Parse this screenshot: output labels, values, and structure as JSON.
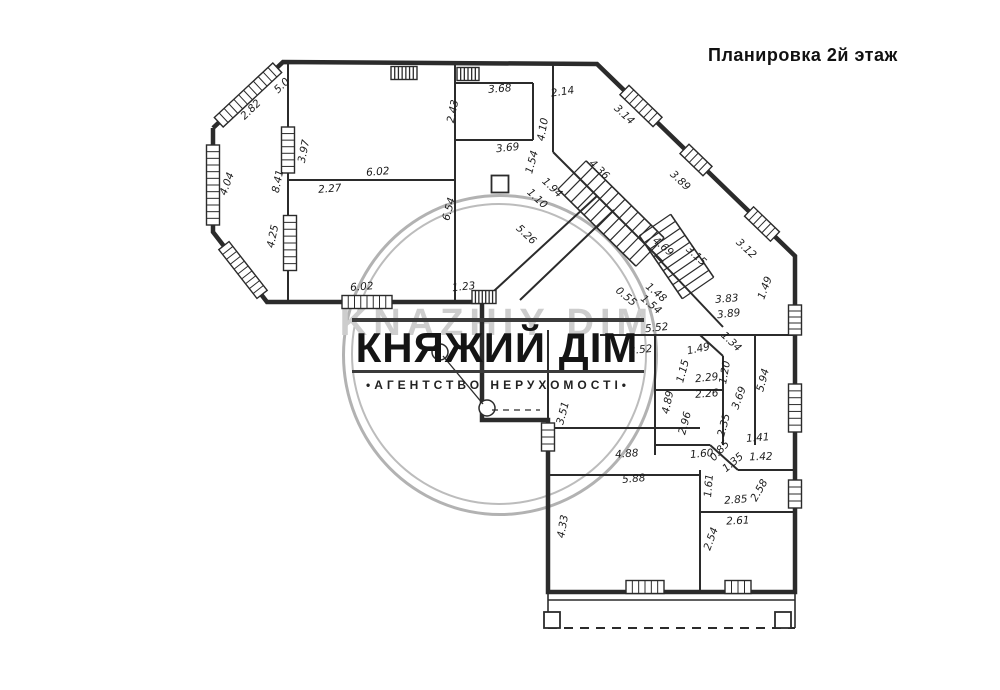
{
  "title": "Планировка 2й этаж",
  "watermark": {
    "name": "КНЯЖИЙ ДІМ",
    "name_latin": "KNAZHIY DIM",
    "tagline": "•АГЕНТСТВО НЕРУХОМОСТІ•",
    "circle_color": "#b2b2b2",
    "text_color": "#141414"
  },
  "plan": {
    "stroke": "#2b2b2b",
    "outer": [
      [
        213,
        128
      ],
      [
        283,
        62
      ],
      [
        597,
        64
      ],
      [
        795,
        256
      ],
      [
        795,
        592
      ],
      [
        548,
        592
      ],
      [
        548,
        420
      ],
      [
        482,
        420
      ],
      [
        482,
        302
      ],
      [
        267,
        302
      ],
      [
        213,
        232
      ],
      [
        213,
        128
      ]
    ],
    "walls": [
      [
        [
          288,
          64
        ],
        [
          288,
          302
        ]
      ],
      [
        [
          288,
          180
        ],
        [
          455,
          180
        ]
      ],
      [
        [
          455,
          64
        ],
        [
          455,
          302
        ]
      ],
      [
        [
          455,
          140
        ],
        [
          533,
          140
        ]
      ],
      [
        [
          533,
          83
        ],
        [
          533,
          140
        ]
      ],
      [
        [
          455,
          83
        ],
        [
          533,
          83
        ]
      ],
      [
        [
          553,
          64
        ],
        [
          553,
          152
        ]
      ],
      [
        [
          553,
          152
        ],
        [
          663,
          262
        ]
      ],
      [
        [
          597,
          196
        ],
        [
          482,
          302
        ]
      ],
      [
        [
          614,
          210
        ],
        [
          520,
          300
        ]
      ],
      [
        [
          655,
          255
        ],
        [
          723,
          327
        ]
      ],
      [
        [
          548,
          330
        ],
        [
          548,
          592
        ]
      ],
      [
        [
          600,
          335
        ],
        [
          795,
          335
        ]
      ],
      [
        [
          700,
          335
        ],
        [
          723,
          356
        ]
      ],
      [
        [
          655,
          335
        ],
        [
          655,
          455
        ]
      ],
      [
        [
          655,
          390
        ],
        [
          723,
          390
        ]
      ],
      [
        [
          723,
          356
        ],
        [
          723,
          445
        ]
      ],
      [
        [
          655,
          445
        ],
        [
          710,
          445
        ]
      ],
      [
        [
          710,
          445
        ],
        [
          738,
          470
        ]
      ],
      [
        [
          738,
          470
        ],
        [
          795,
          470
        ]
      ],
      [
        [
          755,
          335
        ],
        [
          755,
          445
        ]
      ],
      [
        [
          548,
          428
        ],
        [
          700,
          428
        ]
      ],
      [
        [
          548,
          475
        ],
        [
          700,
          475
        ]
      ],
      [
        [
          700,
          470
        ],
        [
          700,
          592
        ]
      ],
      [
        [
          700,
          512
        ],
        [
          795,
          512
        ]
      ]
    ],
    "windows": [
      {
        "cx": 248,
        "cy": 95,
        "len": 80,
        "rot": -43,
        "dense": false
      },
      {
        "cx": 213,
        "cy": 185,
        "len": 80,
        "rot": 90,
        "dense": false
      },
      {
        "cx": 243,
        "cy": 270,
        "len": 62,
        "rot": 52,
        "dense": false
      },
      {
        "cx": 288,
        "cy": 150,
        "len": 46,
        "rot": 90,
        "dense": false
      },
      {
        "cx": 290,
        "cy": 243,
        "len": 55,
        "rot": 90,
        "dense": false
      },
      {
        "cx": 404,
        "cy": 73,
        "len": 26,
        "rot": 0,
        "dense": true
      },
      {
        "cx": 468,
        "cy": 74,
        "len": 22,
        "rot": 0,
        "dense": true
      },
      {
        "cx": 641,
        "cy": 106,
        "len": 46,
        "rot": 44,
        "dense": false
      },
      {
        "cx": 696,
        "cy": 160,
        "len": 32,
        "rot": 44,
        "dense": false
      },
      {
        "cx": 762,
        "cy": 224,
        "len": 36,
        "rot": 44,
        "dense": false
      },
      {
        "cx": 795,
        "cy": 320,
        "len": 30,
        "rot": 90,
        "dense": false
      },
      {
        "cx": 795,
        "cy": 408,
        "len": 48,
        "rot": 90,
        "dense": false
      },
      {
        "cx": 795,
        "cy": 494,
        "len": 28,
        "rot": 90,
        "dense": false
      },
      {
        "cx": 548,
        "cy": 437,
        "len": 28,
        "rot": 90,
        "dense": false
      },
      {
        "cx": 645,
        "cy": 587,
        "len": 38,
        "rot": 0,
        "dense": false
      },
      {
        "cx": 738,
        "cy": 587,
        "len": 26,
        "rot": 0,
        "dense": false
      },
      {
        "cx": 367,
        "cy": 302,
        "len": 50,
        "rot": 0,
        "dense": false
      },
      {
        "cx": 484,
        "cy": 297,
        "len": 24,
        "rot": 0,
        "dense": true
      }
    ],
    "stairs": [
      {
        "x1": 572,
        "y1": 175,
        "x2": 650,
        "y2": 252,
        "w": 40,
        "n": 12
      },
      {
        "x1": 655,
        "y1": 225,
        "x2": 698,
        "y2": 288,
        "w": 38,
        "n": 9
      }
    ],
    "labels": [
      {
        "t": "2.82",
        "x": 253,
        "y": 112,
        "r": -44
      },
      {
        "t": "5.0",
        "x": 284,
        "y": 88,
        "r": -44
      },
      {
        "t": "3.97",
        "x": 307,
        "y": 152,
        "r": -78
      },
      {
        "t": "2.43",
        "x": 456,
        "y": 112,
        "r": -78
      },
      {
        "t": "6.02",
        "x": 378,
        "y": 175,
        "r": -4
      },
      {
        "t": "2.27",
        "x": 330,
        "y": 192,
        "r": -4
      },
      {
        "t": "8.41",
        "x": 281,
        "y": 182,
        "r": -78
      },
      {
        "t": "4.04",
        "x": 230,
        "y": 185,
        "r": -70
      },
      {
        "t": "4.25",
        "x": 276,
        "y": 237,
        "r": -78
      },
      {
        "t": "6.02",
        "x": 362,
        "y": 290,
        "r": -4
      },
      {
        "t": "3.68",
        "x": 500,
        "y": 92,
        "r": -4
      },
      {
        "t": "2.14",
        "x": 563,
        "y": 95,
        "r": -8
      },
      {
        "t": "3.69",
        "x": 508,
        "y": 151,
        "r": -6
      },
      {
        "t": "1.54",
        "x": 535,
        "y": 163,
        "r": -75
      },
      {
        "t": "4.10",
        "x": 546,
        "y": 130,
        "r": -80
      },
      {
        "t": "3.14",
        "x": 622,
        "y": 117,
        "r": 43
      },
      {
        "t": "4.36",
        "x": 597,
        "y": 172,
        "r": 43
      },
      {
        "t": "1.94",
        "x": 550,
        "y": 190,
        "r": 43
      },
      {
        "t": "1.10",
        "x": 535,
        "y": 201,
        "r": 43
      },
      {
        "t": "5.26",
        "x": 524,
        "y": 237,
        "r": 43
      },
      {
        "t": "1.23",
        "x": 464,
        "y": 290,
        "r": -6
      },
      {
        "t": "6.54",
        "x": 452,
        "y": 210,
        "r": -75
      },
      {
        "t": "3.89",
        "x": 678,
        "y": 183,
        "r": 43
      },
      {
        "t": "4.69",
        "x": 661,
        "y": 249,
        "r": 40
      },
      {
        "t": "3.15",
        "x": 694,
        "y": 258,
        "r": 43
      },
      {
        "t": "3.12",
        "x": 744,
        "y": 251,
        "r": 43
      },
      {
        "t": "0.55",
        "x": 624,
        "y": 299,
        "r": 40
      },
      {
        "t": "1.48",
        "x": 654,
        "y": 295,
        "r": 40
      },
      {
        "t": "1.54",
        "x": 649,
        "y": 307,
        "r": 40
      },
      {
        "t": "5.52",
        "x": 657,
        "y": 331,
        "r": -6
      },
      {
        "t": "3.83",
        "x": 727,
        "y": 302,
        "r": -4
      },
      {
        "t": "3.89",
        "x": 729,
        "y": 317,
        "r": -6
      },
      {
        "t": "1.49",
        "x": 768,
        "y": 289,
        "r": -70
      },
      {
        "t": "3.52",
        "x": 641,
        "y": 353,
        "r": -6
      },
      {
        "t": "1.49",
        "x": 699,
        "y": 352,
        "r": -12
      },
      {
        "t": "1.34",
        "x": 729,
        "y": 344,
        "r": 43
      },
      {
        "t": "1.15",
        "x": 686,
        "y": 372,
        "r": -75
      },
      {
        "t": "2.29",
        "x": 707,
        "y": 381,
        "r": -6
      },
      {
        "t": "1.20",
        "x": 728,
        "y": 373,
        "r": -80
      },
      {
        "t": "2.26",
        "x": 707,
        "y": 397,
        "r": -4
      },
      {
        "t": "4.89",
        "x": 671,
        "y": 403,
        "r": -78
      },
      {
        "t": "3.69",
        "x": 742,
        "y": 399,
        "r": -70
      },
      {
        "t": "5.94",
        "x": 766,
        "y": 381,
        "r": -75
      },
      {
        "t": "2.96",
        "x": 688,
        "y": 424,
        "r": -75
      },
      {
        "t": "2.35",
        "x": 727,
        "y": 426,
        "r": -75
      },
      {
        "t": "1.60",
        "x": 702,
        "y": 457,
        "r": -5
      },
      {
        "t": "0.85",
        "x": 722,
        "y": 453,
        "r": -48
      },
      {
        "t": "1.35",
        "x": 735,
        "y": 465,
        "r": -40
      },
      {
        "t": "1.41",
        "x": 758,
        "y": 441,
        "r": -4
      },
      {
        "t": "1.42",
        "x": 761,
        "y": 460,
        "r": -2
      },
      {
        "t": "2.58",
        "x": 762,
        "y": 492,
        "r": -60
      },
      {
        "t": "4.88",
        "x": 627,
        "y": 457,
        "r": -4
      },
      {
        "t": "5.88",
        "x": 634,
        "y": 482,
        "r": -5
      },
      {
        "t": "3.51",
        "x": 566,
        "y": 414,
        "r": -75
      },
      {
        "t": "1.61",
        "x": 712,
        "y": 486,
        "r": -85
      },
      {
        "t": "2.85",
        "x": 736,
        "y": 503,
        "r": -4
      },
      {
        "t": "2.61",
        "x": 738,
        "y": 524,
        "r": -3
      },
      {
        "t": "2.54",
        "x": 714,
        "y": 540,
        "r": -70
      },
      {
        "t": "4.33",
        "x": 566,
        "y": 527,
        "r": -80
      }
    ],
    "balcony": {
      "sides": [
        [
          [
            548,
            592
          ],
          [
            548,
            628
          ]
        ],
        [
          [
            795,
            592
          ],
          [
            795,
            628
          ]
        ],
        [
          [
            548,
            600
          ],
          [
            795,
            600
          ]
        ]
      ],
      "dashed_front": [
        548,
        628,
        795,
        628
      ],
      "posts": [
        [
          548,
          612
        ],
        [
          779,
          612
        ]
      ],
      "post_size": 16
    },
    "decor": {
      "circles": [
        {
          "cx": 440,
          "cy": 352,
          "r": 8
        },
        {
          "cx": 487,
          "cy": 408,
          "r": 8
        }
      ],
      "lines": [
        [
          443,
          356,
          483,
          404
        ]
      ],
      "dashed": [
        [
          492,
          410,
          540,
          410
        ]
      ],
      "squares": [
        {
          "x": 500,
          "y": 184,
          "s": 17
        }
      ]
    }
  }
}
